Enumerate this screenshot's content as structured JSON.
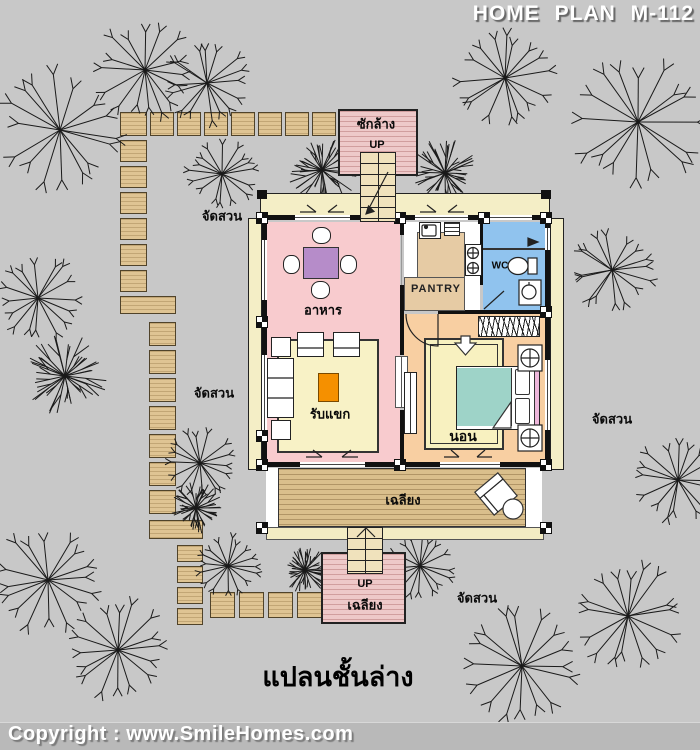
{
  "header": {
    "title": "HOME PLAN M-112"
  },
  "footer": {
    "copyright": "Copyright : www.SmileHomes.com"
  },
  "caption": "แปลนชั้นล่าง",
  "rooms": {
    "dining": "อาหาร",
    "living": "รับแขก",
    "bedroom": "นอน",
    "pantry": "PANTRY",
    "wc": "WC",
    "porch": "เฉลียง",
    "laundry": "ซักล้าง",
    "rear_up": "UP",
    "front_up": "UP",
    "front_porch": "เฉลียง"
  },
  "garden_labels": [
    "จัดสวน",
    "จัดสวน",
    "จัดสวน",
    "จัดสวน"
  ],
  "colors": {
    "background": "#c8c8c8",
    "room_pink": "#f8cbce",
    "room_peach": "#f8cfa2",
    "wc_blue": "#90c3ee",
    "porch_wood": "#dabf8c",
    "pad_pink": "#eec9c9",
    "table_purple": "#b68cc9",
    "table_orange": "#f59000",
    "counter_tan": "#e6cba4",
    "bed_teal": "#9ed3c8",
    "stone_tan": "#dfc493",
    "band_cream": "#f4eec6"
  }
}
